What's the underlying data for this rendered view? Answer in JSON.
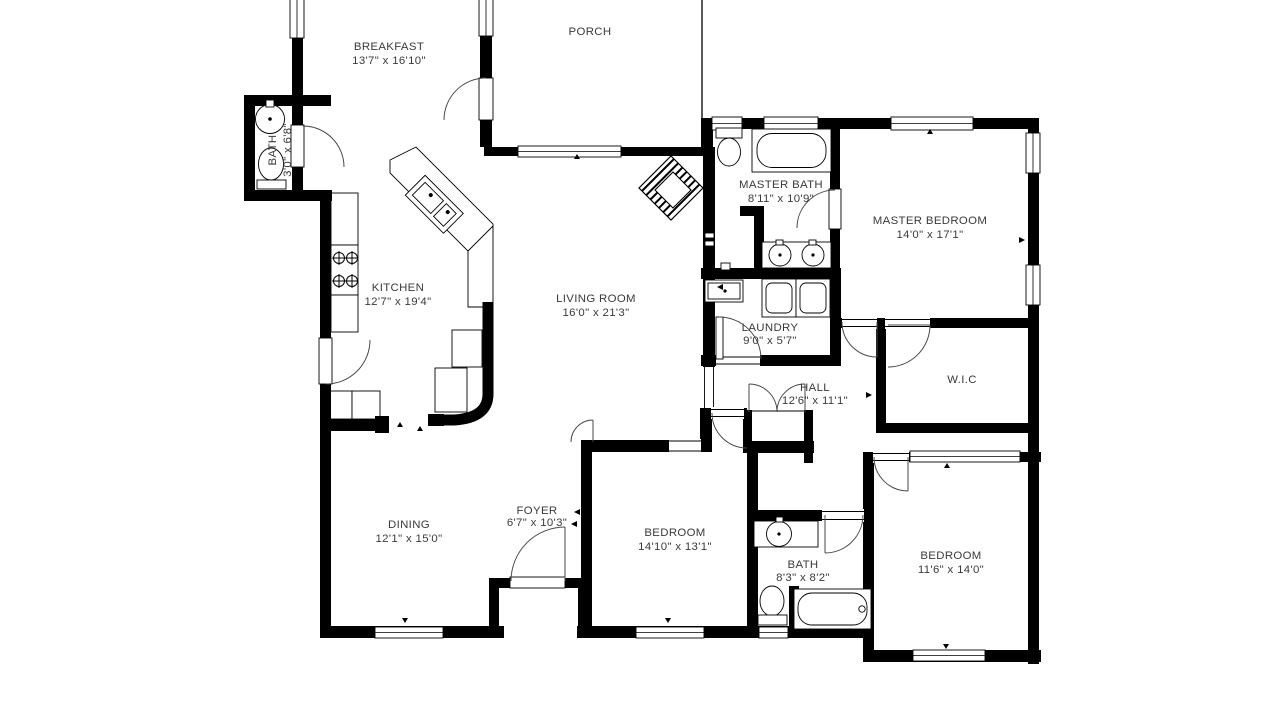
{
  "title": "Floor plan",
  "colors": {
    "wall": "#000000",
    "text": "#3a3a3a",
    "background": "#ffffff",
    "door_arc": "#4a4a4a"
  },
  "rooms": [
    {
      "id": "breakfast",
      "name": "BREAKFAST",
      "dims": "13'7\" x 16'10\""
    },
    {
      "id": "porch",
      "name": "PORCH",
      "dims": ""
    },
    {
      "id": "bath-small",
      "name": "BATH",
      "dims": "3'0\" x 6'8\""
    },
    {
      "id": "master-bath",
      "name": "MASTER BATH",
      "dims": "8'11\" x 10'9\""
    },
    {
      "id": "master-bedroom",
      "name": "MASTER BEDROOM",
      "dims": "14'0\" x 17'1\""
    },
    {
      "id": "kitchen",
      "name": "KITCHEN",
      "dims": "12'7\" x 19'4\""
    },
    {
      "id": "living-room",
      "name": "LIVING ROOM",
      "dims": "16'0\" x 21'3\""
    },
    {
      "id": "laundry",
      "name": "LAUNDRY",
      "dims": "9'0\" x 5'7\""
    },
    {
      "id": "hall",
      "name": "HALL",
      "dims": "12'6\" x 11'1\""
    },
    {
      "id": "wic",
      "name": "W.I.C",
      "dims": ""
    },
    {
      "id": "dining",
      "name": "DINING",
      "dims": "12'1\" x 15'0\""
    },
    {
      "id": "foyer",
      "name": "FOYER",
      "dims": "6'7\" x 10'3\""
    },
    {
      "id": "bedroom-1",
      "name": "BEDROOM",
      "dims": "14'10\" x 13'1\""
    },
    {
      "id": "bath-2",
      "name": "BATH",
      "dims": "8'3\" x 8'2\""
    },
    {
      "id": "bedroom-2",
      "name": "BEDROOM",
      "dims": "11'6\" x 14'0\""
    }
  ]
}
